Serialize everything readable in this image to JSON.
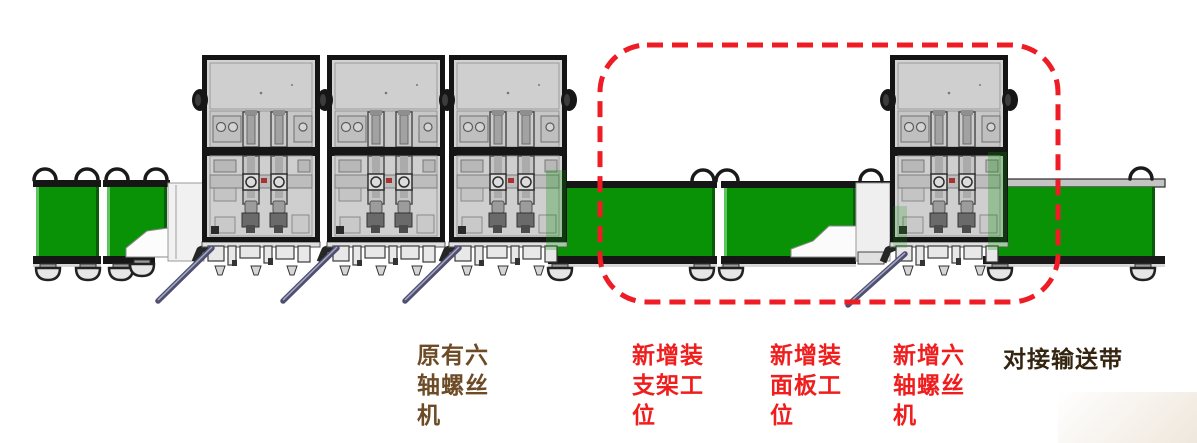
{
  "labels": [
    {
      "name": "original-six-axis-screw-machine",
      "text": "原有六\n轴螺丝\n机"
    },
    {
      "name": "new-bracket-assembly-station",
      "text": "新增装\n支架工\n位"
    },
    {
      "name": "new-panel-assembly-station",
      "text": "新增装\n面板工\n位"
    },
    {
      "name": "new-six-axis-screw-machine",
      "text": "新增六\n轴螺丝\n机"
    },
    {
      "name": "docking-conveyor-belt",
      "text": "对接输送带"
    }
  ],
  "colors": {
    "green": "#0a9206",
    "green_light": "#5fc45f",
    "green_dark": "#0a5c0a",
    "dashed_red": "#ee1c24",
    "label_red": "#f01d1d",
    "label_brown": "#6d4b27",
    "label_dark": "#342510",
    "rod_blue": "#4f4f72",
    "frame_black": "#161616",
    "machine_gray": "#d3d3d3"
  }
}
